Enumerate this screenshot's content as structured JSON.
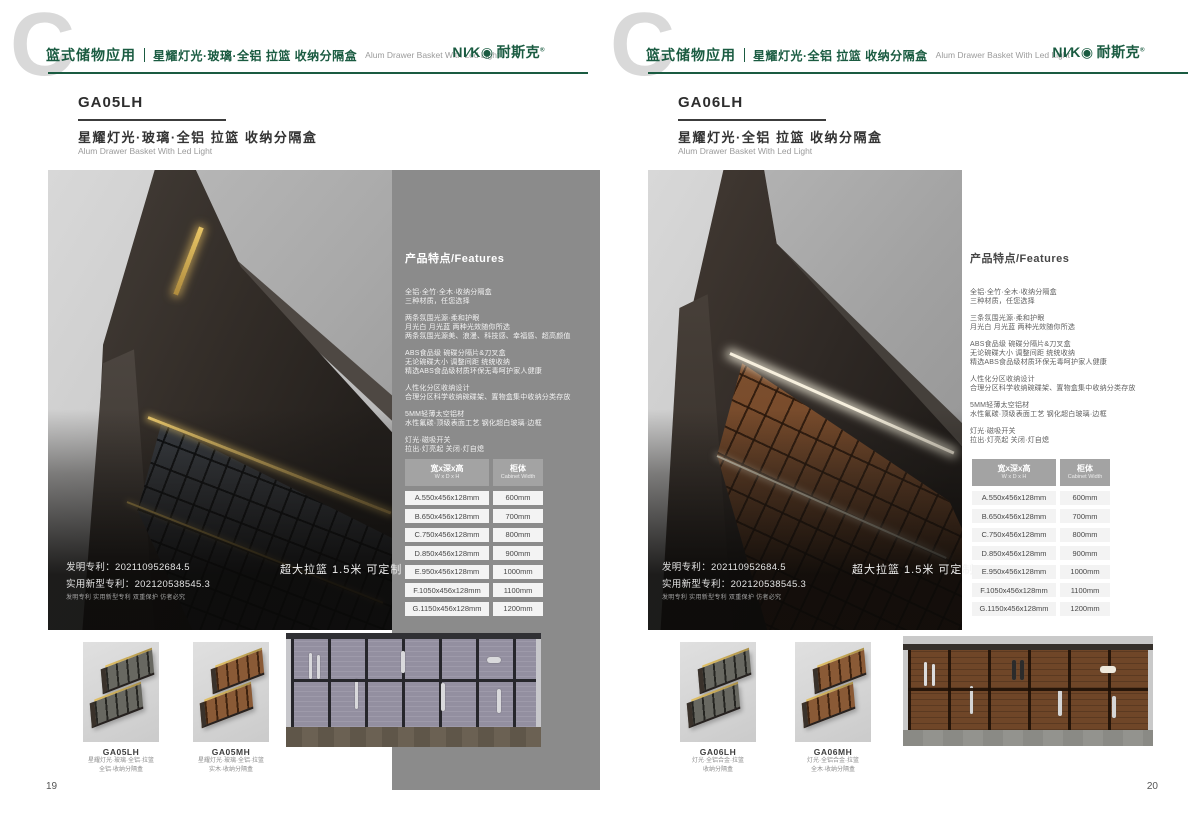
{
  "colors": {
    "accent_green": "#1a5b41",
    "panel_gray": "#8b8b8b",
    "led_gold": "#d9b459",
    "led_white": "#f7f0de"
  },
  "brand": {
    "name_en": "NI∕K◉",
    "name_cn": "耐斯克",
    "reg": "®"
  },
  "features_heading": "产品特点/Features",
  "patent": {
    "line1": "发明专利：202110952684.5",
    "line2": "实用新型专利：202120538545.3",
    "line3": "发明专利 实用新型专利 双重保护 仿者必究"
  },
  "badge": "超大拉篮 1.5米 可定制",
  "size_table": {
    "col1_cn": "宽x深x高",
    "col1_en": "W x D x H",
    "col2_cn": "柜体",
    "col2_en": "Cabinet Width",
    "rows": [
      [
        "A.550x456x128mm",
        "600mm"
      ],
      [
        "B.650x456x128mm",
        "700mm"
      ],
      [
        "C.750x456x128mm",
        "800mm"
      ],
      [
        "D.850x456x128mm",
        "900mm"
      ],
      [
        "E.950x456x128mm",
        "1000mm"
      ],
      [
        "F.1050x456x128mm",
        "1100mm"
      ],
      [
        "G.1150x456x128mm",
        "1200mm"
      ]
    ]
  },
  "pages": [
    {
      "watermark": "C",
      "category": "篮式储物应用",
      "subtitle": "星耀灯光·玻璃·全铝 拉篮 收纳分隔盒",
      "subtitle_en": "Alum Drawer Basket With Led Light",
      "code": "GA05LH",
      "title": "星耀灯光·玻璃·全铝 拉篮 收纳分隔盒",
      "title_en": "Alum Drawer Basket With Led Light",
      "feature_groups": [
        [
          "全铝·全竹·全木·收纳分隔盒",
          "三种材质，任您选择"
        ],
        [
          "两条氛围光源·柔和护眼",
          "月光白 月光蓝 两种光效随你所选",
          "两条氛围光源美、浪漫、科技感、幸福感、超高颜值"
        ],
        [
          "ABS食品级 碗碟分隔片&刀叉盒",
          "无论碗碟大小 调整间距 统统收纳",
          "精选ABS食品级材质环保无毒呵护家人健康"
        ],
        [
          "人性化分区收纳设计",
          "合理分区科学收纳碗碟架、置物盒集中收纳分类存放"
        ],
        [
          "5MM轻薄太空铝材",
          "水性氟碳·顶级表面工艺 钢化超白玻璃·边框"
        ],
        [
          "灯光·磁吸开关",
          "拉出·灯亮起 关闭·灯自熄"
        ]
      ],
      "thumbs": [
        {
          "code": "GA05LH",
          "line1": "星耀灯光·玻璃·全铝·拉篮",
          "line2": "全铝·收纳分隔盒"
        },
        {
          "code": "GA05MH",
          "line1": "星耀灯光·玻璃·全铝·拉篮",
          "line2": "实木·收纳分隔盒"
        }
      ],
      "page_number": "19"
    },
    {
      "watermark": "C",
      "category": "篮式储物应用",
      "subtitle": "星耀灯光·全铝 拉篮 收纳分隔盒",
      "subtitle_en": "Alum Drawer Basket With Led Light",
      "code": "GA06LH",
      "title": "星耀灯光·全铝 拉篮 收纳分隔盒",
      "title_en": "Alum Drawer Basket With Led Light",
      "feature_groups": [
        [
          "全铝·全竹·全木·收纳分隔盒",
          "三种材质，任您选择"
        ],
        [
          "三条氛围光源·柔和护眼",
          "月光白 月光蓝 两种光效随你所选"
        ],
        [
          "ABS食品级 碗碟分隔片&刀叉盒",
          "无论碗碟大小 调整间距 统统收纳",
          "精选ABS食品级材质环保无毒呵护家人健康"
        ],
        [
          "人性化分区收纳设计",
          "合理分区科学收纳碗碟架、置物盒集中收纳分类存放"
        ],
        [
          "5MM轻薄太空铝材",
          "水性氟碳·顶级表面工艺 钢化超白玻璃·边框"
        ],
        [
          "灯光·磁吸开关",
          "拉出·灯亮起 关闭·灯自熄"
        ]
      ],
      "thumbs": [
        {
          "code": "GA06LH",
          "line1": "灯光·全铝合金·拉篮",
          "line2": "收纳分隔盒"
        },
        {
          "code": "GA06MH",
          "line1": "灯光·全铝合金·拉篮",
          "line2": "全木·收纳分隔盒"
        }
      ],
      "page_number": "20"
    }
  ]
}
